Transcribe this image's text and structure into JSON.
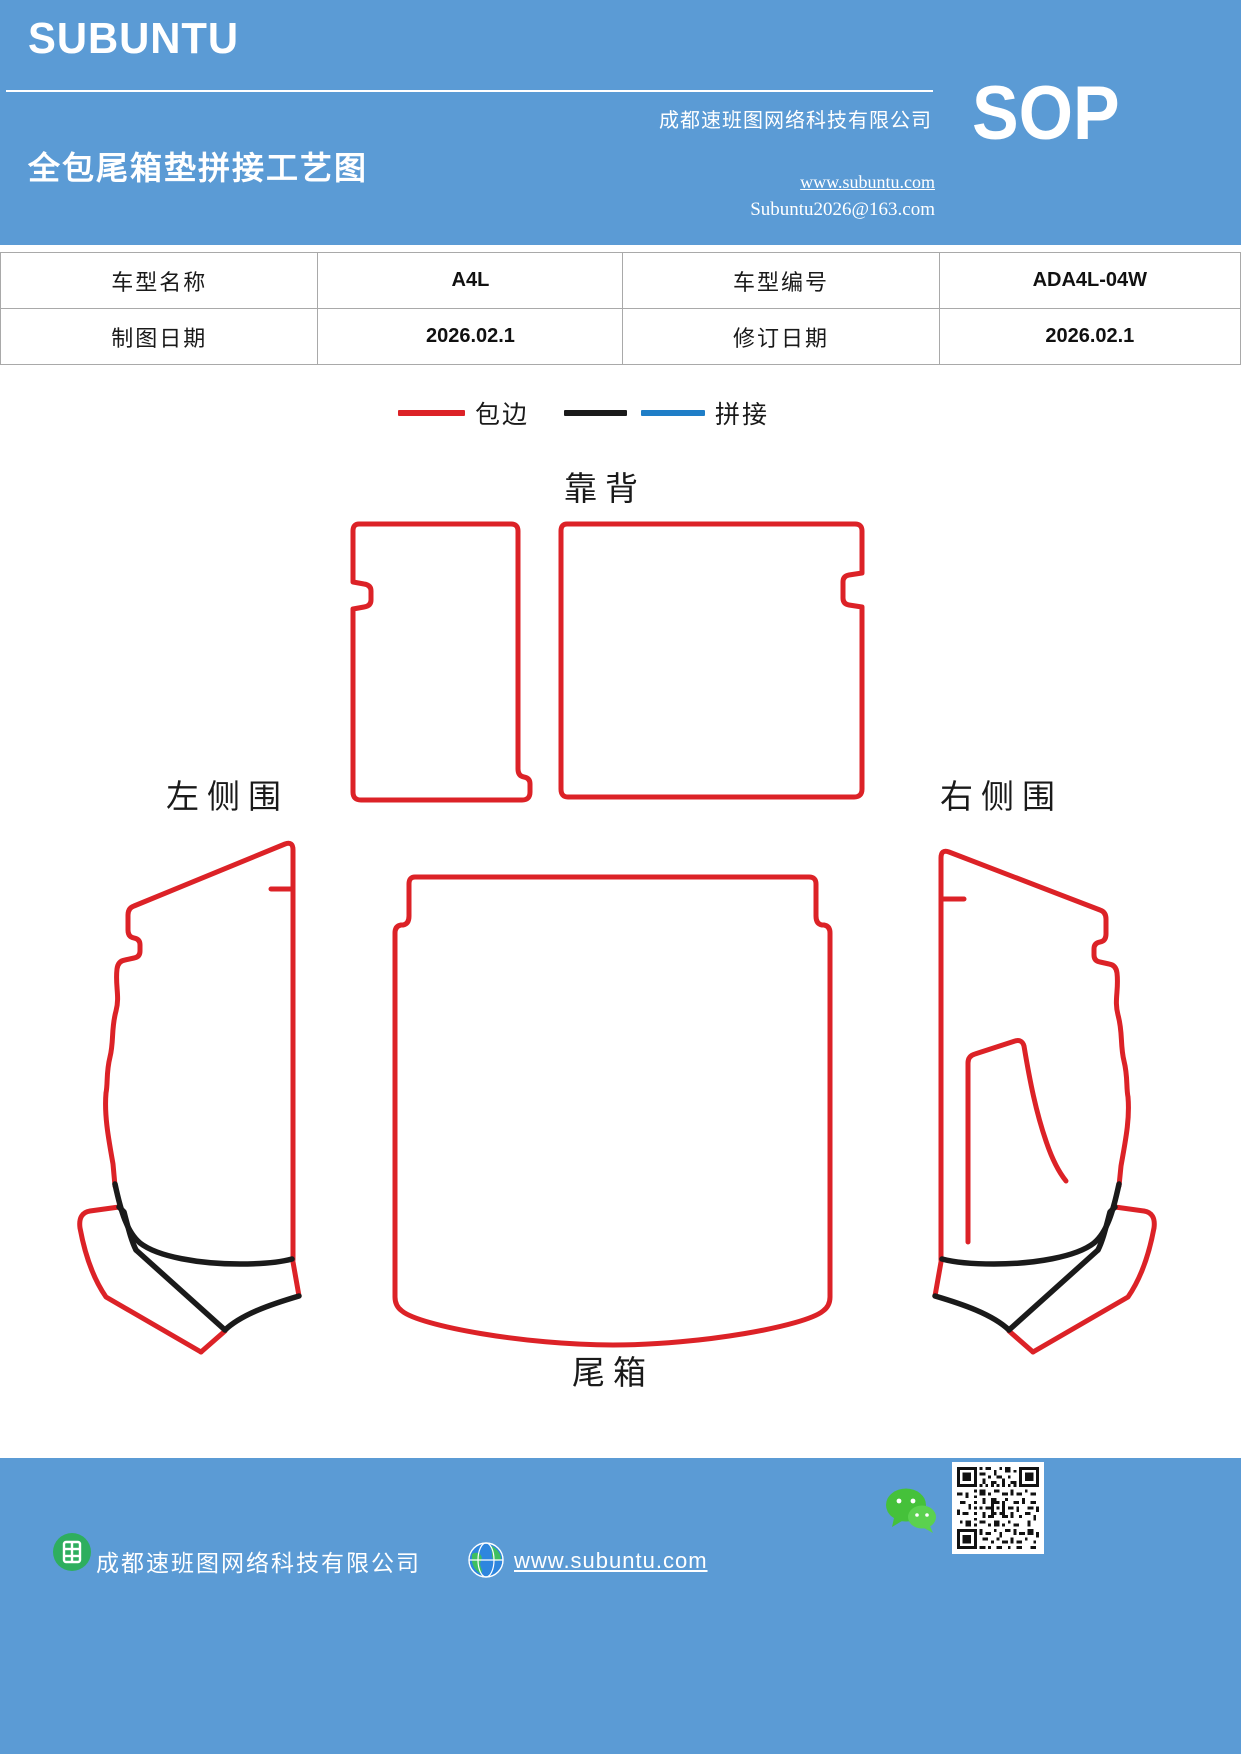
{
  "header": {
    "logo": "SUBUNTU",
    "company": "成都速班图网络科技有限公司",
    "title": "全包尾箱垫拼接工艺图",
    "website": "www.subuntu.com",
    "email": "Subuntu2026@163.com",
    "doc_type": "SOP",
    "bg_color": "#5B9BD5"
  },
  "info_table": {
    "rows": [
      [
        "车型名称",
        "A4L",
        "车型编号",
        "ADA4L-04W"
      ],
      [
        "制图日期",
        "2026.02.1",
        "修订日期",
        "2026.02.1"
      ]
    ]
  },
  "legend": {
    "items": [
      {
        "label": "包边",
        "colors": [
          "#DC2227"
        ]
      },
      {
        "label": "拼接",
        "colors": [
          "#1A1A1A",
          "#1F7EC7"
        ]
      }
    ]
  },
  "diagram": {
    "labels": {
      "backrest": "靠背",
      "left_side": "左侧围",
      "right_side": "右侧围",
      "trunk": "尾箱"
    },
    "edge_binding_color": "#DC2227",
    "stitch_color": "#1A1A1A",
    "splice_color": "#1F7EC7"
  },
  "footer": {
    "company": "成都速班图网络科技有限公司",
    "website": "www.subuntu.com"
  }
}
